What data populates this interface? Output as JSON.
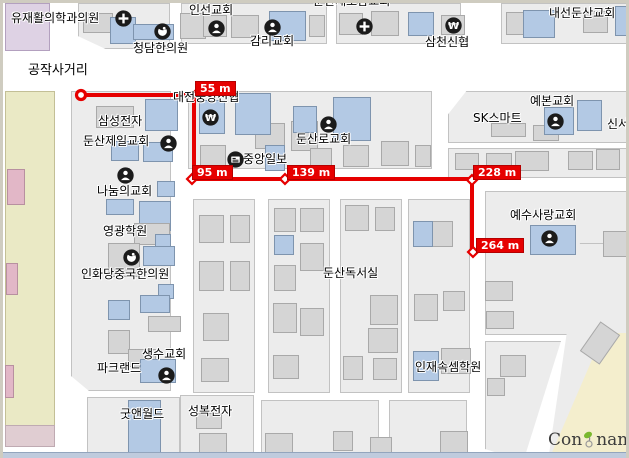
{
  "map": {
    "width": 629,
    "height": 458,
    "colors": {
      "street": "#ffffff",
      "block": "#ececec",
      "block_border": "#c2c2c2",
      "building_gray": "#d5d5d5",
      "building_blue": "#b3c9e4",
      "building_pink": "#e2b7c7",
      "zone_khaki": "#eae9c5",
      "zone_lavender": "#ded2e4",
      "zone_cream": "#f4eecd",
      "zone_pink_strip": "#e0cdd2",
      "route_red": "#e60000",
      "badge_text": "#ffffff",
      "icon_circle": "#1b1b1b",
      "logo_green": "#7ab82e"
    },
    "areas": [
      {
        "name": "zone-lavender",
        "x": 2,
        "y": 0,
        "w": 45,
        "h": 48,
        "color": "#ded2e4",
        "border": "#b3a0bf",
        "z": 1
      },
      {
        "name": "zone-khaki-strip",
        "x": 2,
        "y": 88,
        "w": 50,
        "h": 344,
        "color": "#eae9c5",
        "border": "#c3bf96",
        "z": 1
      },
      {
        "name": "zone-pink-strip",
        "x": 2,
        "y": 422,
        "w": 50,
        "h": 22,
        "color": "#e0cdd2",
        "border": "#bfaab2",
        "z": 1
      },
      {
        "name": "zone-cream-wedge",
        "x": 540,
        "y": 330,
        "w": 89,
        "h": 128,
        "color": "#f4eecd",
        "border": "#d6cc9e",
        "z": 3,
        "clip": "polygon(68% 0,100% 0,100% 100%,6% 100%)"
      }
    ],
    "blocks": [
      {
        "x": 75,
        "y": 0,
        "w": 92,
        "h": 46,
        "clip": "polygon(0 0,100% 0,100% 100%,30% 100%,0 72%)"
      },
      {
        "x": 178,
        "y": 0,
        "w": 146,
        "h": 41
      },
      {
        "x": 333,
        "y": 0,
        "w": 125,
        "h": 41
      },
      {
        "x": 498,
        "y": 0,
        "w": 131,
        "h": 41
      },
      {
        "x": 68,
        "y": 88,
        "w": 100,
        "h": 300,
        "clip": "polygon(0 0,100% 0,100% 100%,18% 100%,0 95%)"
      },
      {
        "x": 185,
        "y": 88,
        "w": 244,
        "h": 78
      },
      {
        "x": 445,
        "y": 88,
        "w": 184,
        "h": 52,
        "clip": "polygon(10% 0,100% 0,100% 100%,0 100%,0 45%)"
      },
      {
        "x": 445,
        "y": 145,
        "w": 184,
        "h": 30
      },
      {
        "x": 482,
        "y": 188,
        "w": 147,
        "h": 144,
        "clip": "polygon(0 0,100% 0,100% 40%,56% 100%,0 100%)"
      },
      {
        "x": 190,
        "y": 196,
        "w": 62,
        "h": 194
      },
      {
        "x": 265,
        "y": 196,
        "w": 62,
        "h": 194
      },
      {
        "x": 337,
        "y": 196,
        "w": 62,
        "h": 194
      },
      {
        "x": 405,
        "y": 196,
        "w": 62,
        "h": 194
      },
      {
        "x": 482,
        "y": 338,
        "w": 80,
        "h": 120,
        "clip": "polygon(0 0,95% 0,48% 100%,0 90%)"
      },
      {
        "x": 545,
        "y": 240,
        "w": 84,
        "h": 218,
        "clip": "polygon(38% 0,100% 0,100% 40%,50% 100%,0 100%)"
      },
      {
        "x": 84,
        "y": 394,
        "w": 93,
        "h": 64
      },
      {
        "x": 177,
        "y": 392,
        "w": 74,
        "h": 66
      },
      {
        "x": 258,
        "y": 397,
        "w": 118,
        "h": 61
      },
      {
        "x": 386,
        "y": 397,
        "w": 78,
        "h": 61
      }
    ],
    "buildings": [
      {
        "x": 80,
        "y": 10,
        "w": 30,
        "h": 20,
        "c": "g"
      },
      {
        "x": 107,
        "y": 14,
        "w": 26,
        "h": 27,
        "c": "b"
      },
      {
        "x": 130,
        "y": 21,
        "w": 41,
        "h": 16,
        "c": "b"
      },
      {
        "x": 177,
        "y": 10,
        "w": 26,
        "h": 26,
        "c": "g"
      },
      {
        "x": 200,
        "y": 12,
        "w": 24,
        "h": 22,
        "c": "g"
      },
      {
        "x": 228,
        "y": 12,
        "w": 28,
        "h": 23,
        "c": "g"
      },
      {
        "x": 266,
        "y": 8,
        "w": 37,
        "h": 30,
        "c": "b"
      },
      {
        "x": 306,
        "y": 12,
        "w": 16,
        "h": 22,
        "c": "g"
      },
      {
        "x": 336,
        "y": 10,
        "w": 24,
        "h": 22,
        "c": "g"
      },
      {
        "x": 368,
        "y": 8,
        "w": 28,
        "h": 25,
        "c": "g"
      },
      {
        "x": 405,
        "y": 9,
        "w": 26,
        "h": 24,
        "c": "b"
      },
      {
        "x": 438,
        "y": 12,
        "w": 24,
        "h": 20,
        "c": "g"
      },
      {
        "x": 503,
        "y": 9,
        "w": 25,
        "h": 23,
        "c": "g"
      },
      {
        "x": 520,
        "y": 7,
        "w": 32,
        "h": 28,
        "c": "b"
      },
      {
        "x": 580,
        "y": 8,
        "w": 25,
        "h": 22,
        "c": "g"
      },
      {
        "x": 612,
        "y": 3,
        "w": 16,
        "h": 30,
        "c": "b"
      },
      {
        "x": 93,
        "y": 103,
        "w": 38,
        "h": 22,
        "c": "g"
      },
      {
        "x": 142,
        "y": 96,
        "w": 33,
        "h": 32,
        "c": "b"
      },
      {
        "x": 108,
        "y": 138,
        "w": 28,
        "h": 20,
        "c": "b"
      },
      {
        "x": 140,
        "y": 139,
        "w": 30,
        "h": 20,
        "c": "b"
      },
      {
        "x": 154,
        "y": 178,
        "w": 18,
        "h": 16,
        "c": "b"
      },
      {
        "x": 103,
        "y": 196,
        "w": 28,
        "h": 16,
        "c": "b"
      },
      {
        "x": 136,
        "y": 198,
        "w": 32,
        "h": 30,
        "c": "b"
      },
      {
        "x": 131,
        "y": 220,
        "w": 36,
        "h": 22,
        "c": "g"
      },
      {
        "x": 152,
        "y": 231,
        "w": 16,
        "h": 22,
        "c": "b"
      },
      {
        "x": 105,
        "y": 240,
        "w": 32,
        "h": 34,
        "c": "g"
      },
      {
        "x": 140,
        "y": 243,
        "w": 32,
        "h": 20,
        "c": "b"
      },
      {
        "x": 155,
        "y": 281,
        "w": 16,
        "h": 15,
        "c": "b"
      },
      {
        "x": 105,
        "y": 297,
        "w": 22,
        "h": 20,
        "c": "b"
      },
      {
        "x": 137,
        "y": 292,
        "w": 30,
        "h": 18,
        "c": "b"
      },
      {
        "x": 145,
        "y": 313,
        "w": 33,
        "h": 16,
        "c": "g"
      },
      {
        "x": 105,
        "y": 327,
        "w": 22,
        "h": 24,
        "c": "g"
      },
      {
        "x": 125,
        "y": 346,
        "w": 28,
        "h": 18,
        "c": "g"
      },
      {
        "x": 137,
        "y": 356,
        "w": 36,
        "h": 24,
        "c": "b"
      },
      {
        "x": 252,
        "y": 120,
        "w": 30,
        "h": 26,
        "c": "g"
      },
      {
        "x": 288,
        "y": 118,
        "w": 27,
        "h": 30,
        "c": "g"
      },
      {
        "x": 197,
        "y": 142,
        "w": 26,
        "h": 22,
        "c": "g"
      },
      {
        "x": 307,
        "y": 145,
        "w": 22,
        "h": 20,
        "c": "g"
      },
      {
        "x": 340,
        "y": 142,
        "w": 26,
        "h": 22,
        "c": "g"
      },
      {
        "x": 378,
        "y": 138,
        "w": 28,
        "h": 25,
        "c": "g"
      },
      {
        "x": 412,
        "y": 142,
        "w": 16,
        "h": 22,
        "c": "g"
      },
      {
        "x": 196,
        "y": 97,
        "w": 26,
        "h": 34,
        "c": "b"
      },
      {
        "x": 232,
        "y": 90,
        "w": 36,
        "h": 42,
        "c": "b"
      },
      {
        "x": 290,
        "y": 103,
        "w": 24,
        "h": 27,
        "c": "b"
      },
      {
        "x": 330,
        "y": 94,
        "w": 38,
        "h": 44,
        "c": "b"
      },
      {
        "x": 262,
        "y": 142,
        "w": 20,
        "h": 26,
        "c": "b"
      },
      {
        "x": 488,
        "y": 120,
        "w": 35,
        "h": 14,
        "c": "g"
      },
      {
        "x": 530,
        "y": 122,
        "w": 26,
        "h": 16,
        "c": "g"
      },
      {
        "x": 541,
        "y": 104,
        "w": 30,
        "h": 28,
        "c": "b"
      },
      {
        "x": 574,
        "y": 97,
        "w": 25,
        "h": 31,
        "c": "b"
      },
      {
        "x": 452,
        "y": 150,
        "w": 24,
        "h": 17,
        "c": "g"
      },
      {
        "x": 483,
        "y": 150,
        "w": 26,
        "h": 18,
        "c": "g"
      },
      {
        "x": 512,
        "y": 148,
        "w": 34,
        "h": 20,
        "c": "g"
      },
      {
        "x": 565,
        "y": 148,
        "w": 25,
        "h": 19,
        "c": "g"
      },
      {
        "x": 593,
        "y": 146,
        "w": 24,
        "h": 21,
        "c": "g"
      },
      {
        "x": 482,
        "y": 278,
        "w": 28,
        "h": 20,
        "c": "g"
      },
      {
        "x": 483,
        "y": 308,
        "w": 28,
        "h": 18,
        "c": "g"
      },
      {
        "x": 600,
        "y": 228,
        "w": 24,
        "h": 26,
        "c": "g"
      },
      {
        "x": 527,
        "y": 222,
        "w": 46,
        "h": 30,
        "c": "b"
      },
      {
        "x": 196,
        "y": 212,
        "w": 25,
        "h": 28,
        "c": "g"
      },
      {
        "x": 227,
        "y": 212,
        "w": 20,
        "h": 28,
        "c": "g"
      },
      {
        "x": 196,
        "y": 258,
        "w": 25,
        "h": 30,
        "c": "g"
      },
      {
        "x": 227,
        "y": 258,
        "w": 20,
        "h": 30,
        "c": "g"
      },
      {
        "x": 200,
        "y": 310,
        "w": 26,
        "h": 28,
        "c": "g"
      },
      {
        "x": 198,
        "y": 355,
        "w": 28,
        "h": 24,
        "c": "g"
      },
      {
        "x": 271,
        "y": 205,
        "w": 22,
        "h": 24,
        "c": "g"
      },
      {
        "x": 297,
        "y": 205,
        "w": 24,
        "h": 24,
        "c": "g"
      },
      {
        "x": 297,
        "y": 240,
        "w": 24,
        "h": 28,
        "c": "g"
      },
      {
        "x": 271,
        "y": 262,
        "w": 22,
        "h": 26,
        "c": "g"
      },
      {
        "x": 271,
        "y": 232,
        "w": 20,
        "h": 20,
        "c": "b"
      },
      {
        "x": 270,
        "y": 300,
        "w": 24,
        "h": 30,
        "c": "g"
      },
      {
        "x": 297,
        "y": 305,
        "w": 24,
        "h": 28,
        "c": "g"
      },
      {
        "x": 270,
        "y": 352,
        "w": 26,
        "h": 24,
        "c": "g"
      },
      {
        "x": 342,
        "y": 202,
        "w": 24,
        "h": 26,
        "c": "g"
      },
      {
        "x": 372,
        "y": 204,
        "w": 20,
        "h": 24,
        "c": "g"
      },
      {
        "x": 367,
        "y": 292,
        "w": 28,
        "h": 30,
        "c": "g"
      },
      {
        "x": 365,
        "y": 325,
        "w": 30,
        "h": 25,
        "c": "g"
      },
      {
        "x": 340,
        "y": 353,
        "w": 20,
        "h": 24,
        "c": "g"
      },
      {
        "x": 370,
        "y": 355,
        "w": 24,
        "h": 22,
        "c": "g"
      },
      {
        "x": 428,
        "y": 218,
        "w": 22,
        "h": 26,
        "c": "g"
      },
      {
        "x": 410,
        "y": 218,
        "w": 20,
        "h": 26,
        "c": "b"
      },
      {
        "x": 411,
        "y": 291,
        "w": 24,
        "h": 27,
        "c": "g"
      },
      {
        "x": 440,
        "y": 288,
        "w": 22,
        "h": 20,
        "c": "g"
      },
      {
        "x": 438,
        "y": 345,
        "w": 30,
        "h": 26,
        "c": "g"
      },
      {
        "x": 410,
        "y": 348,
        "w": 26,
        "h": 30,
        "c": "b"
      },
      {
        "x": 497,
        "y": 352,
        "w": 26,
        "h": 22,
        "c": "g"
      },
      {
        "x": 484,
        "y": 375,
        "w": 18,
        "h": 18,
        "c": "g"
      },
      {
        "x": 585,
        "y": 322,
        "w": 24,
        "h": 36,
        "c": "g",
        "rot": 35
      },
      {
        "x": 125,
        "y": 397,
        "w": 33,
        "h": 59,
        "c": "b"
      },
      {
        "x": 193,
        "y": 410,
        "w": 26,
        "h": 16,
        "c": "g"
      },
      {
        "x": 196,
        "y": 430,
        "w": 28,
        "h": 24,
        "c": "g"
      },
      {
        "x": 262,
        "y": 430,
        "w": 28,
        "h": 26,
        "c": "g"
      },
      {
        "x": 330,
        "y": 428,
        "w": 20,
        "h": 20,
        "c": "g"
      },
      {
        "x": 367,
        "y": 434,
        "w": 22,
        "h": 20,
        "c": "g"
      },
      {
        "x": 437,
        "y": 428,
        "w": 28,
        "h": 24,
        "c": "g"
      },
      {
        "x": 4,
        "y": 166,
        "w": 18,
        "h": 36,
        "c": "p"
      },
      {
        "x": 3,
        "y": 260,
        "w": 12,
        "h": 32,
        "c": "p"
      },
      {
        "x": 2,
        "y": 362,
        "w": 9,
        "h": 33,
        "c": "p"
      }
    ],
    "labels": [
      {
        "name": "label-yujae-clinic",
        "text": "유재활의학과의원",
        "x": 8,
        "y": 6
      },
      {
        "name": "label-cheongdam-clinic",
        "text": "청담한의원",
        "x": 130,
        "y": 36
      },
      {
        "name": "label-inseon-church",
        "text": "인선교회",
        "x": 186,
        "y": -2
      },
      {
        "name": "label-gamni-church",
        "text": "감리교회",
        "x": 247,
        "y": 29
      },
      {
        "name": "clipped-top-label",
        "text": "둔산새로남교회",
        "x": 310,
        "y": -11
      },
      {
        "name": "label-samcheon-bank",
        "text": "삼천신협",
        "x": 422,
        "y": 30
      },
      {
        "name": "label-naeseon-church",
        "text": "내선둔산교회",
        "x": 546,
        "y": 1
      },
      {
        "name": "label-gongjak-intersection",
        "text": "공작사거리",
        "x": 25,
        "y": 56,
        "fs": 13
      },
      {
        "name": "label-daejeon-jungang-bank",
        "text": "대전중앙신협",
        "x": 170,
        "y": 85
      },
      {
        "name": "label-samsung-electronics",
        "text": "삼성전자",
        "x": 95,
        "y": 109
      },
      {
        "name": "label-dunsan-jeil-church",
        "text": "둔산제일교회",
        "x": 80,
        "y": 129
      },
      {
        "name": "label-jungang-ilbo",
        "text": "중앙일보",
        "x": 240,
        "y": 147
      },
      {
        "name": "label-dunsanro-church",
        "text": "둔산로교회",
        "x": 293,
        "y": 127
      },
      {
        "name": "label-sk-smart",
        "text": "SK스마트",
        "x": 470,
        "y": 106
      },
      {
        "name": "label-yebon-church",
        "text": "예본교회",
        "x": 527,
        "y": 89
      },
      {
        "name": "label-sinseo-clipped",
        "text": "신서",
        "x": 604,
        "y": 112
      },
      {
        "name": "label-nanum-church",
        "text": "나눔의교회",
        "x": 94,
        "y": 179
      },
      {
        "name": "label-yeonggwang-academy",
        "text": "영광학원",
        "x": 100,
        "y": 219
      },
      {
        "name": "label-inhwadang-clinic",
        "text": "인화당중국한의원",
        "x": 78,
        "y": 262
      },
      {
        "name": "label-yesu-sarang-church",
        "text": "예수사랑교회",
        "x": 507,
        "y": 203
      },
      {
        "name": "label-dunsan-reading-room",
        "text": "둔산독서실",
        "x": 320,
        "y": 261
      },
      {
        "name": "label-injae-academy",
        "text": "인재속셈학원",
        "x": 412,
        "y": 355
      },
      {
        "name": "label-saengsu-church",
        "text": "생수교회",
        "x": 139,
        "y": 342
      },
      {
        "name": "label-parkland",
        "text": "파크랜드",
        "x": 94,
        "y": 356
      },
      {
        "name": "label-good-n-world",
        "text": "굿앤월드",
        "x": 117,
        "y": 402
      },
      {
        "name": "label-seongbok-electronics",
        "text": "성복전자",
        "x": 185,
        "y": 399
      }
    ],
    "icons": [
      {
        "name": "hospital-cross-icon",
        "type": "cross",
        "x": 112,
        "y": 7
      },
      {
        "name": "oriental-medicine-icon",
        "type": "med",
        "x": 151,
        "y": 20
      },
      {
        "name": "church-icon",
        "type": "person",
        "x": 205,
        "y": 17
      },
      {
        "name": "church-icon",
        "type": "person",
        "x": 261,
        "y": 16
      },
      {
        "name": "hospital-cross-icon",
        "type": "cross",
        "x": 353,
        "y": 15
      },
      {
        "name": "bank-won-icon",
        "type": "won",
        "x": 442,
        "y": 14
      },
      {
        "name": "bank-won-icon",
        "type": "won",
        "x": 199,
        "y": 106
      },
      {
        "name": "newspaper-icon",
        "type": "news",
        "x": 224,
        "y": 148
      },
      {
        "name": "church-icon",
        "type": "person",
        "x": 317,
        "y": 113
      },
      {
        "name": "church-icon",
        "type": "person",
        "x": 157,
        "y": 132
      },
      {
        "name": "church-icon",
        "type": "person",
        "x": 114,
        "y": 164
      },
      {
        "name": "oriental-medicine-icon",
        "type": "med",
        "x": 120,
        "y": 246
      },
      {
        "name": "church-icon",
        "type": "person",
        "x": 544,
        "y": 110
      },
      {
        "name": "church-icon",
        "type": "person",
        "x": 538,
        "y": 227
      },
      {
        "name": "church-icon",
        "type": "person",
        "x": 155,
        "y": 364
      }
    ],
    "route": {
      "color": "#e60000",
      "points": [
        [
          78,
          92
        ],
        [
          191,
          92
        ],
        [
          191,
          176
        ],
        [
          469,
          176
        ],
        [
          469,
          249
        ]
      ],
      "start": [
        78,
        92
      ],
      "vertices": [
        [
          193,
          92
        ],
        [
          189,
          176
        ],
        [
          282,
          176
        ],
        [
          469,
          177
        ],
        [
          470,
          249
        ]
      ],
      "badges": [
        {
          "text": "55 m",
          "x": 192,
          "y": 78
        },
        {
          "text": "95 m",
          "x": 189,
          "y": 162
        },
        {
          "text": "139 m",
          "x": 284,
          "y": 162
        },
        {
          "text": "228 m",
          "x": 470,
          "y": 162
        },
        {
          "text": "264 m",
          "x": 473,
          "y": 235
        }
      ]
    },
    "logo": {
      "part1": "Con",
      "part2": "namul"
    }
  }
}
